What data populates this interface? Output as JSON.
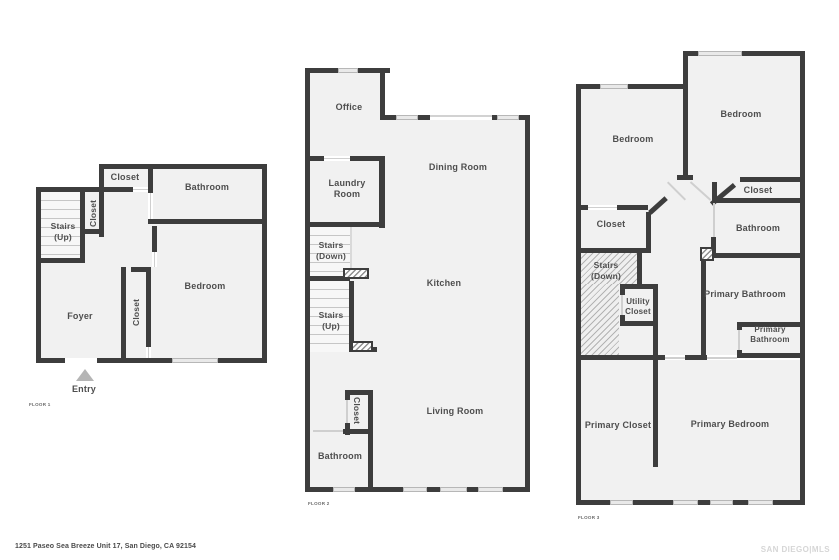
{
  "document": {
    "address": "1251 Paseo Sea Breeze Unit 17, San Diego, CA 92154",
    "watermark": "SAN DIEGO|MLS"
  },
  "colors": {
    "wall": "#3d3d3d",
    "room_fill": "#f1f1f1",
    "label_text": "#4e4e4e",
    "window_fill": "#e9e9e9",
    "watermark_text": "#d6d6d6"
  },
  "floor1": {
    "name": "FLOOR 1",
    "rooms": {
      "closet_top": "Closet",
      "bathroom": "Bathroom",
      "stairs": "Stairs (Up)",
      "closet_stairs": "Closet",
      "bedroom": "Bedroom",
      "closet_bedroom": "Closet",
      "foyer": "Foyer",
      "entry": "Entry"
    }
  },
  "floor2": {
    "name": "FLOOR 2",
    "rooms": {
      "office": "Office",
      "dining_room": "Dining Room",
      "laundry_room": "Laundry Room",
      "stairs_down": "Stairs (Down)",
      "stairs_up": "Stairs (Up)",
      "kitchen": "Kitchen",
      "living_room": "Living Room",
      "closet": "Closet",
      "bathroom": "Bathroom"
    }
  },
  "floor3": {
    "name": "FLOOR 3",
    "rooms": {
      "bedroom_left": "Bedroom",
      "bedroom_right": "Bedroom",
      "closet_right": "Closet",
      "bathroom": "Bathroom",
      "closet_left": "Closet",
      "stairs_down": "Stairs (Down)",
      "utility_closet": "Utility Closet",
      "primary_bathroom": "Primary Bathroom",
      "primary_bathroom_2": "Primary Bathroom",
      "primary_closet": "Primary Closet",
      "primary_bedroom": "Primary Bedroom"
    }
  }
}
